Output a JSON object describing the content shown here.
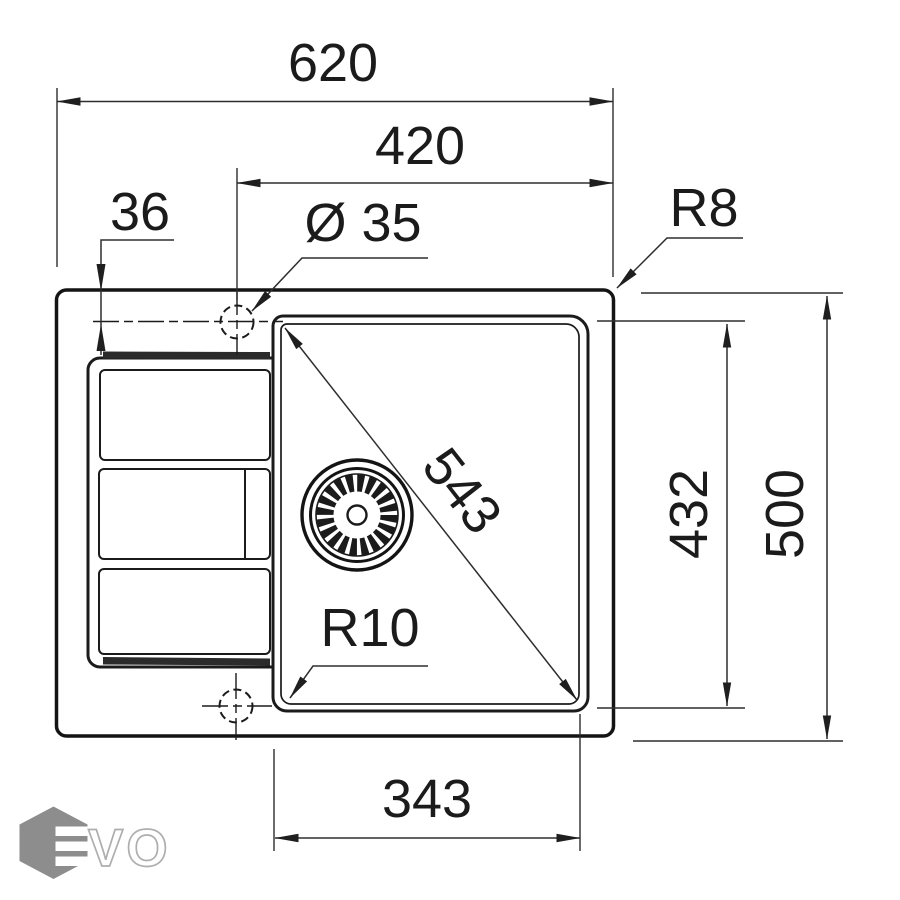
{
  "drawing": {
    "labels": {
      "overall_width": "620",
      "inner_width": "420",
      "tap_offset": "36",
      "tap_diameter": "Ø 35",
      "outer_corner_radius": "R8",
      "bowl_diagonal": "543",
      "bowl_depth": "432",
      "overall_depth": "500",
      "bowl_corner_radius": "R10",
      "bowl_bottom_width": "343"
    },
    "colors": {
      "line": "#1b1b1b",
      "dimension": "#2e2e2e",
      "background": "#ffffff",
      "logo_hexagon": "#8d8d8d",
      "logo_letter_outline": "#aeaeae"
    },
    "logo": {
      "vo": "VO"
    }
  }
}
